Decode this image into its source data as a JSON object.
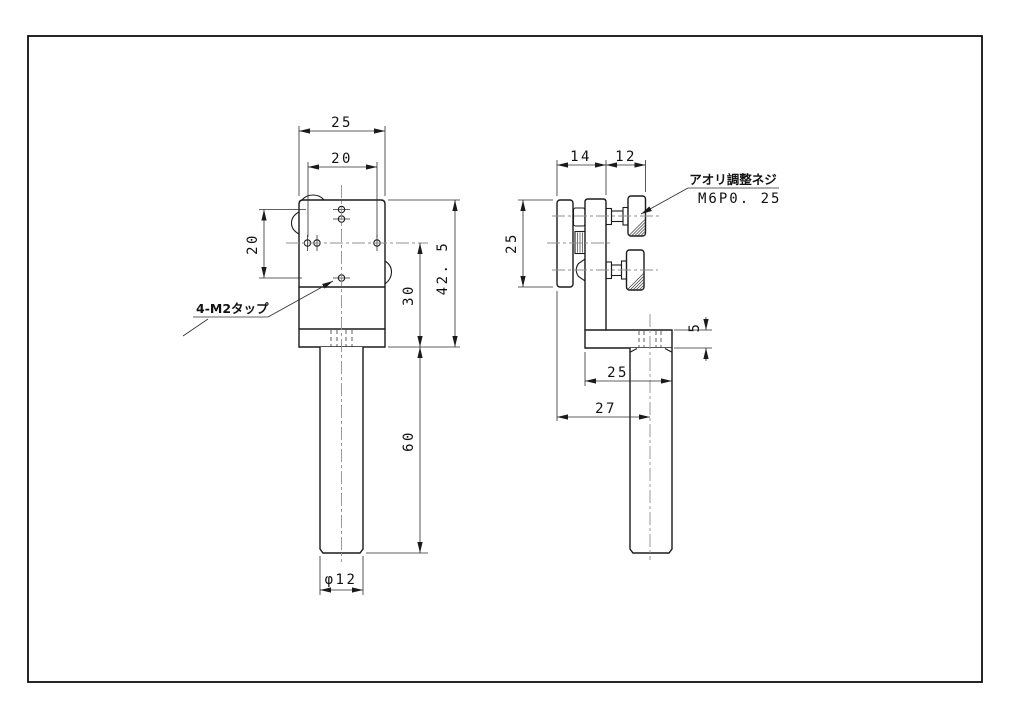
{
  "drawing": {
    "type": "mechanical-drawing",
    "colors": {
      "line": "#1b1b1b",
      "centerline": "#8f8f8f",
      "background": "#ffffff"
    },
    "front_view": {
      "dim_width_outer": "25",
      "dim_width_hole_pitch": "20",
      "dim_height_hole_pitch": "20",
      "dim_height_body": "30",
      "dim_height_total": "42. 5",
      "dim_shaft_length": "60",
      "dim_shaft_diameter": "φ12",
      "label_tap_holes": "4-M2タップ"
    },
    "side_view": {
      "dim_body_depth": "14",
      "dim_knob_length": "12",
      "dim_plate_height": "25",
      "dim_base_thickness": "5",
      "dim_base_depth": "25",
      "dim_total_depth": "27",
      "label_adjust_screw": "アオリ調整ネジ",
      "label_screw_spec": "M6P0. 25"
    }
  }
}
